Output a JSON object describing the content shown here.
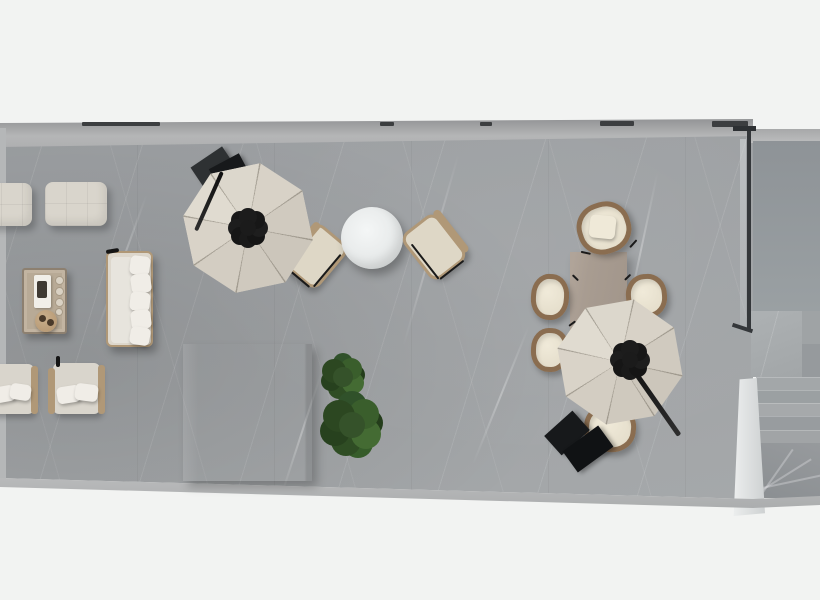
{
  "scene": {
    "label": "Top-down 3D floor plan render of a marble terrace lounge with two parasols, lounge seating, bistro set, dining set, plants, bar block and a winder staircase"
  },
  "regions": {
    "terrace_floor": "Grey marble terrace floor",
    "top_wall": "Upper facade wall band",
    "bottom_wall": "Lower parapet wall band",
    "left_wall": "Left wall edge",
    "glass_partition": "Dark-framed glass partition",
    "interior_wall": "Interior landing wall",
    "stairs": "Marble winder staircase",
    "stair_landing": "Stair landing",
    "railing_wall": "White stair parapet wall"
  },
  "objects": {
    "ottoman_1": "Outdoor ottoman",
    "ottoman_2": "Outdoor ottoman",
    "coffee_table": "Coffee table with serving tray, cups and snack plate",
    "sofa": "Outdoor sofa with ivory cushions",
    "armchair_1": "Lounge armchair with pillows",
    "armchair_2": "Lounge armchair with pillows",
    "counter_block": "Grey bar counter block",
    "plant_1": "Potted green plant",
    "plant_2": "Potted green plant",
    "parasol_1": "Octagonal cantilever parasol with black pole and base",
    "parasol_2": "Octagonal cantilever parasol with black pole and base",
    "bistro_table": "Round white bistro table",
    "side_table": "Small round side table",
    "bistro_chair_left": "Bistro armchair",
    "bistro_chair_right": "Bistro armchair",
    "dining_table": "Taupe rectangular dining table",
    "dining_chair_top": "Rattan dining chair with cushion",
    "dining_chair_left_1": "Rattan dining chair",
    "dining_chair_left_2": "Rattan dining chair",
    "dining_chair_right": "Rattan dining chair",
    "dining_chair_bottom": "Rattan dining chair"
  },
  "colors": {
    "bg": "#f2f3f2",
    "floorA": "#9b9ea1",
    "floorB": "#a5a8aa",
    "cream": "#d9d5cc",
    "tan": "#b09877",
    "rattan": "#8a6d50",
    "plant": "#35522a",
    "hub": "#1b1b1b"
  }
}
